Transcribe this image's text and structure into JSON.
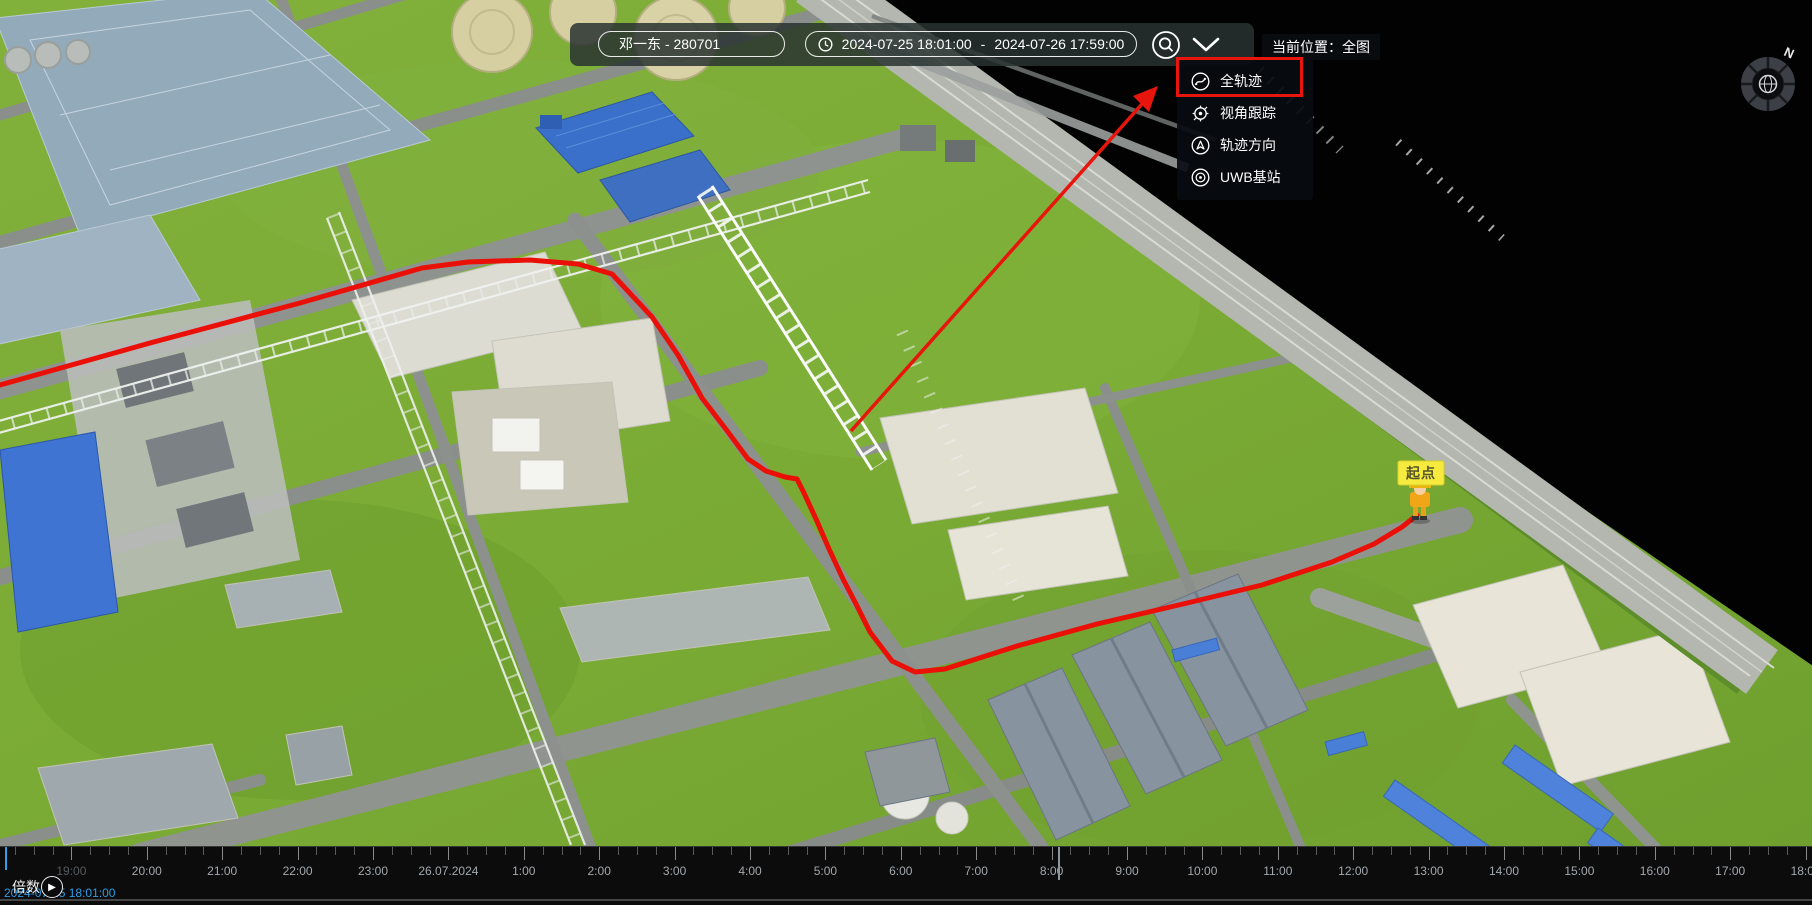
{
  "toolbar": {
    "person": "邓一东 - 280701",
    "time_start": "2024-07-25 18:01:00",
    "time_separator": "-",
    "time_end": "2024-07-26 17:59:00"
  },
  "location_label": "当前位置：全图",
  "dropdown": {
    "items": [
      {
        "label": "全轨迹",
        "icon": "full-trajectory-icon",
        "highlighted": true
      },
      {
        "label": "视角跟踪",
        "icon": "view-tracking-icon",
        "highlighted": false
      },
      {
        "label": "轨迹方向",
        "icon": "trajectory-direction-icon",
        "highlighted": false
      },
      {
        "label": "UWB基站",
        "icon": "uwb-station-icon",
        "highlighted": false
      }
    ]
  },
  "map": {
    "start_label": "起点",
    "compass_n": "N"
  },
  "timeline": {
    "speed_label": "倍数",
    "current_time": "2024-07-25 18:01:00",
    "hour_spacing_px": 75.4,
    "origin_x": -4,
    "ticks": [
      "19:00",
      "20:00",
      "21:00",
      "22:00",
      "23:00",
      "26.07.2024",
      "1:00",
      "2:00",
      "3:00",
      "4:00",
      "5:00",
      "6:00",
      "7:00",
      "8:00",
      "9:00",
      "10:00",
      "11:00",
      "12:00",
      "13:00",
      "14:00",
      "15:00",
      "16:00",
      "17:00",
      "18:00"
    ]
  },
  "colors": {
    "accent_red": "#e8150d",
    "playhead_blue": "#2f9fe8",
    "start_label_yellow": "#f5ea3d",
    "grass_green": "#7aad36",
    "toolbar_bg": "rgba(40,51,48,0.85)"
  }
}
